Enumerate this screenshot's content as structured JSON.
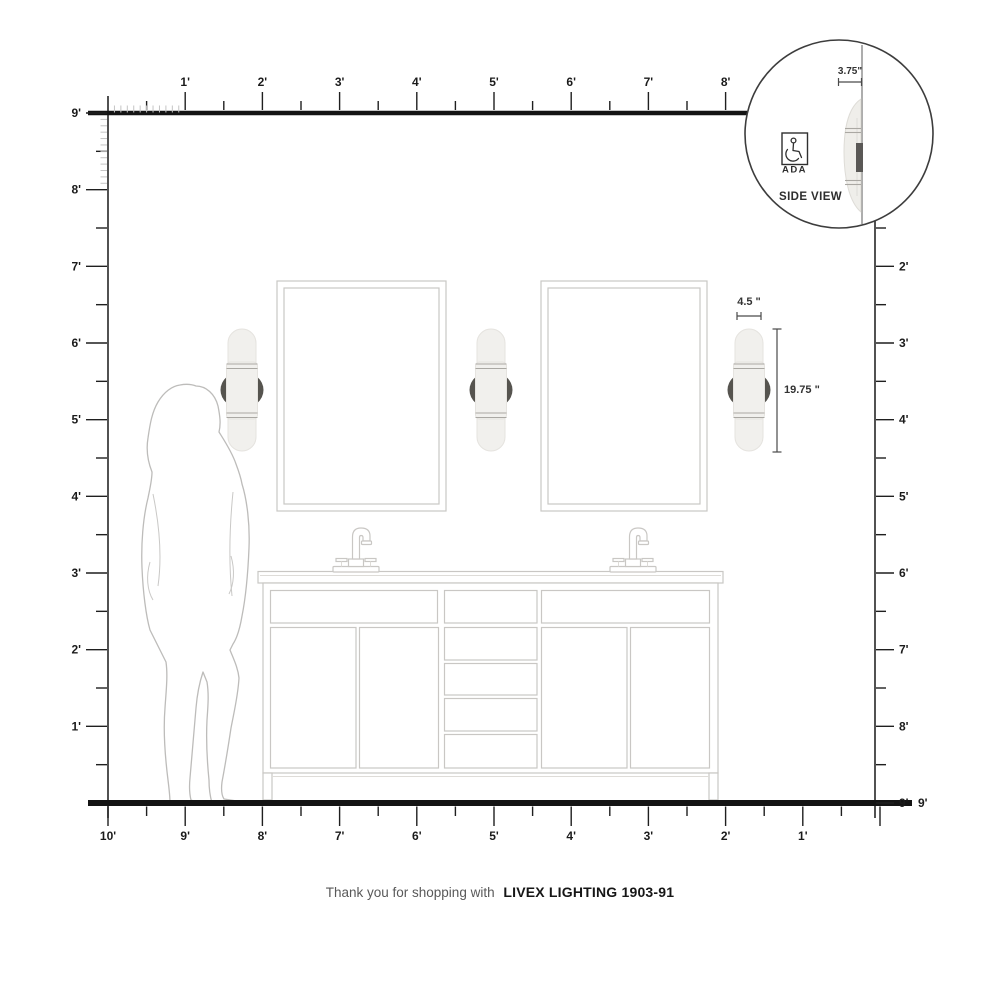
{
  "footer": {
    "prefix": "Thank you for shopping with",
    "brand": "LIVEX LIGHTING 1903-91"
  },
  "inset": {
    "offset_label": "3.75\"",
    "ada_label": "ADA",
    "view_label": "SIDE VIEW"
  },
  "fixture_dimensions": {
    "width_label": "4.5 \"",
    "height_label": "19.75 \""
  },
  "rulers": {
    "top": [
      "1'",
      "2'",
      "3'",
      "4'",
      "5'",
      "6'",
      "7'",
      "8'"
    ],
    "left": [
      "9'",
      "8'",
      "7'",
      "6'",
      "5'",
      "4'",
      "3'",
      "2'",
      "1'"
    ],
    "right": [
      "2'",
      "3'",
      "4'",
      "5'",
      "6'",
      "7'",
      "8'",
      "9'"
    ],
    "bottom": [
      "10'",
      "9'",
      "8'",
      "7'",
      "6'",
      "5'",
      "4'",
      "3'",
      "2'",
      "1'"
    ],
    "floor_right_label": "9'"
  },
  "colors": {
    "ruler_line": "#1f1f1f",
    "fine_tick": "#c4c4c4",
    "drawing_outline": "#c9c7c4",
    "figure_outline": "#bdbcba",
    "sconce_body": "#f1f0ed",
    "sconce_mount": "#56544f",
    "dimension": "#4a4a4a",
    "footer_gray": "#595959",
    "footer_dark": "#161616"
  }
}
